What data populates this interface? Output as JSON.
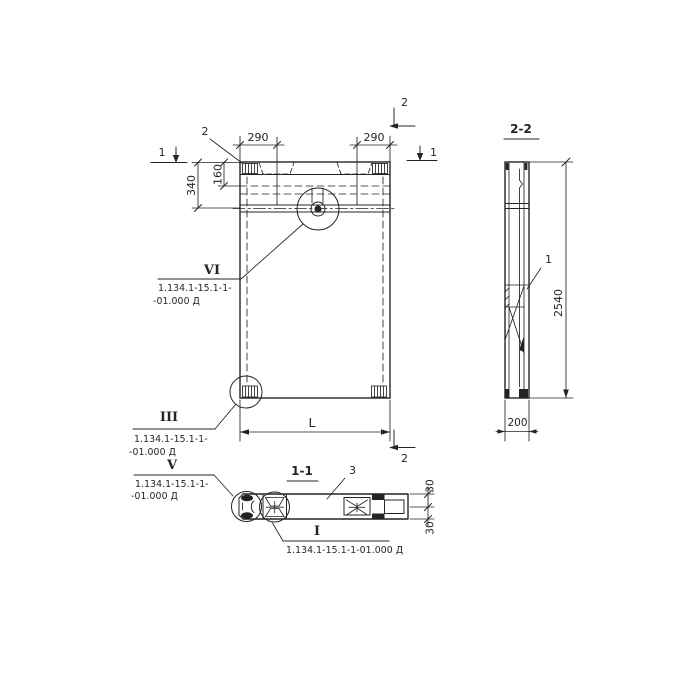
{
  "colors": {
    "ink": "#242424",
    "paper": "#ffffff"
  },
  "front_view": {
    "part_label_2": "2",
    "section_mark_2_top": "2",
    "section_mark_2_bottom": "2",
    "section_mark_1_left": "1",
    "section_mark_1_right": "1",
    "dim_290_left": "290",
    "dim_290_right": "290",
    "dim_340": "340",
    "dim_160": "160",
    "dim_length": "L",
    "callout_vi": {
      "numeral": "VI",
      "line1": "1.134.1-15.1-1-",
      "line2": "-01.000 Д"
    },
    "callout_iii": {
      "numeral": "III",
      "line1": "1.134.1-15.1-1-",
      "line2": "-01.000 Д"
    }
  },
  "section_1_1": {
    "title": "1-1",
    "part_label_3": "3",
    "dim_30_top": "30",
    "dim_30_bottom": "30",
    "callout_v": {
      "numeral": "V",
      "line1": "1.134.1-15.1-1-",
      "line2": "-01.000 Д"
    },
    "callout_i": {
      "numeral": "I",
      "line1": "1.134.1-15.1-1-01.000 Д"
    }
  },
  "section_2_2": {
    "title": "2-2",
    "part_label_1": "1",
    "dim_height": "2540",
    "dim_width": "200"
  }
}
